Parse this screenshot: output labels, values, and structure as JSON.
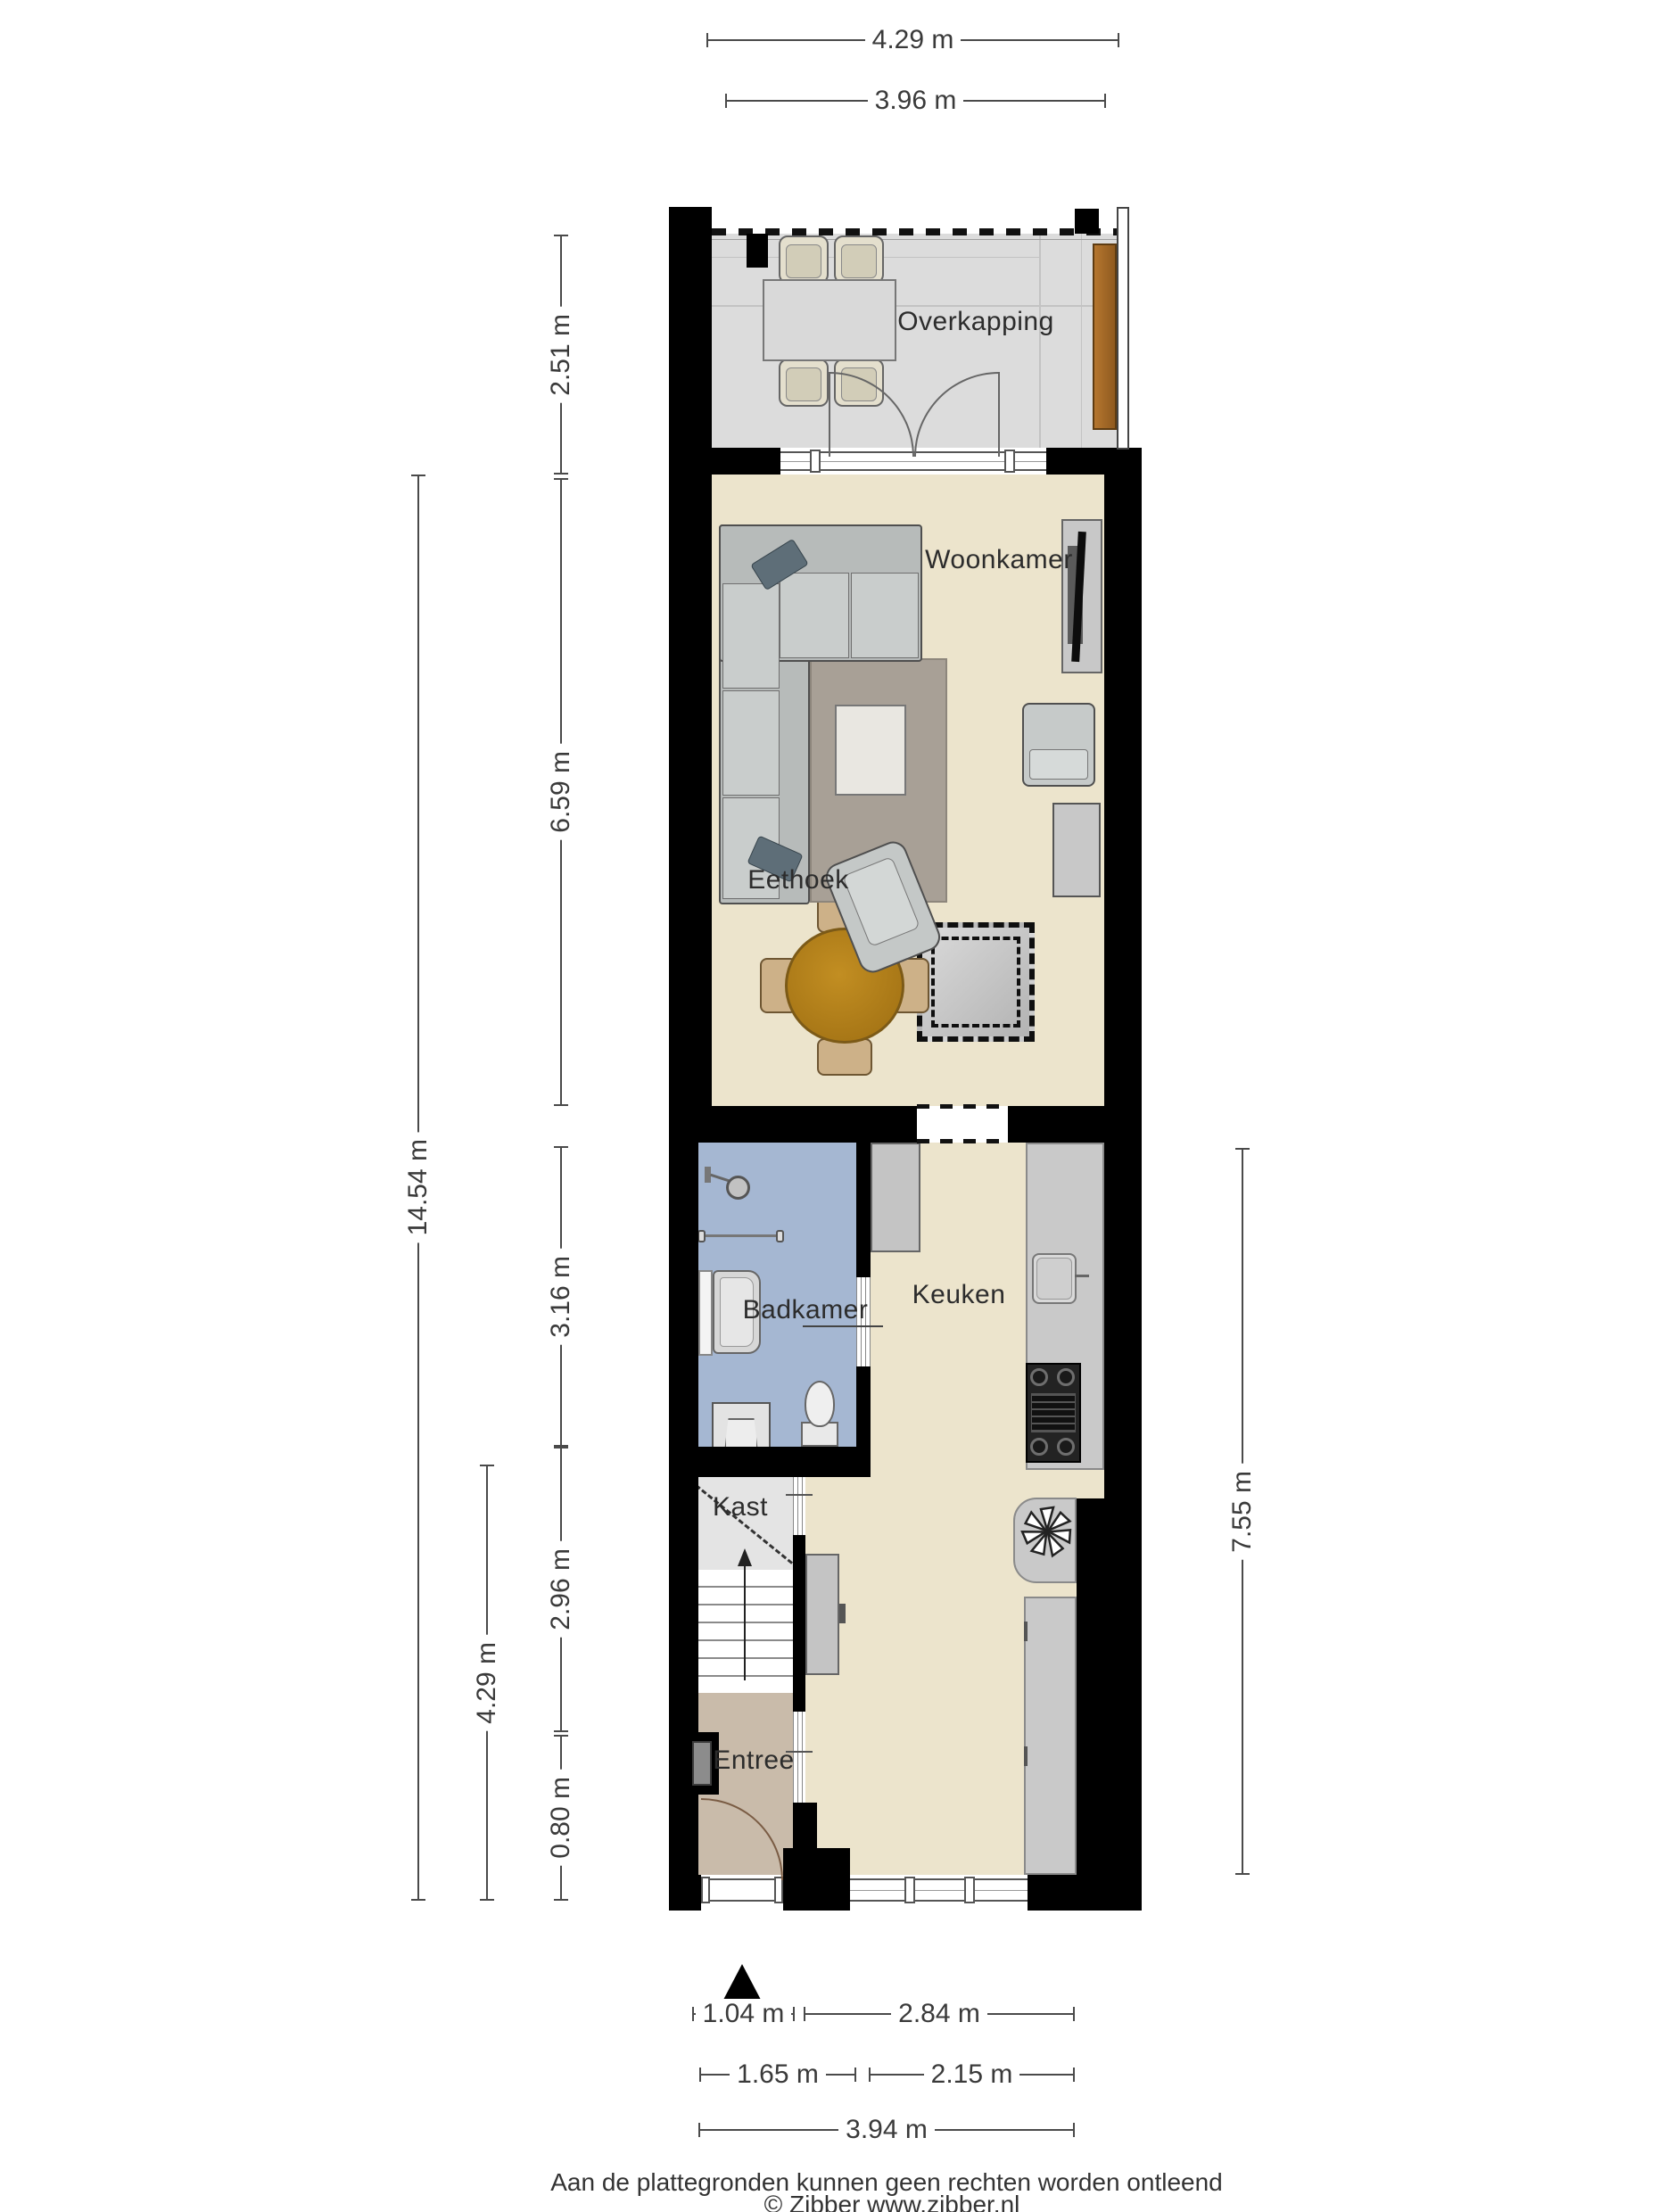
{
  "plan": {
    "title": "Begane grond plattegrond",
    "rooms": [
      {
        "id": "overkapping",
        "label": "Overkapping"
      },
      {
        "id": "woonkamer",
        "label": "Woonkamer"
      },
      {
        "id": "eethoek",
        "label": "Eethoek"
      },
      {
        "id": "badkamer",
        "label": "Badkamer"
      },
      {
        "id": "keuken",
        "label": "Keuken"
      },
      {
        "id": "kast",
        "label": "Kast"
      },
      {
        "id": "entree",
        "label": "Entree"
      }
    ],
    "dimensions": {
      "top": [
        {
          "label": "4.29 m"
        },
        {
          "label": "3.96 m"
        }
      ],
      "left": [
        {
          "label": "2.51 m"
        },
        {
          "label": "6.59 m"
        },
        {
          "label": "3.16 m"
        },
        {
          "label": "2.96 m"
        },
        {
          "label": "0.80 m"
        },
        {
          "label": "4.29 m"
        },
        {
          "label": "14.54 m"
        }
      ],
      "right": [
        {
          "label": "7.55 m"
        }
      ],
      "bottom": [
        {
          "label": "1.04 m"
        },
        {
          "label": "2.84 m"
        },
        {
          "label": "1.65 m"
        },
        {
          "label": "2.15 m"
        },
        {
          "label": "3.94 m"
        }
      ]
    },
    "icons": {
      "north_arrow": "north-arrow",
      "extractor_fan": "fan-icon",
      "shower": "shower-icon",
      "stairs_up": "stairs-up-arrow"
    },
    "colors": {
      "wall": "#000000",
      "floor_living": "#ece4cc",
      "floor_terrace": "#dcdcdc",
      "floor_bath": "#a5b7d2",
      "floor_entry": "#c9bbaa",
      "floor_closet": "#e4e4e4",
      "counter": "#c9c9c9",
      "table_wood": "#b07c1a",
      "fence_wood": "#a4692a",
      "dimension_text": "#3a3a3a"
    }
  },
  "footer": {
    "disclaimer": "Aan de plattegronden kunnen geen rechten worden ontleend",
    "copyright": "© Zibber www.zibber.nl"
  }
}
